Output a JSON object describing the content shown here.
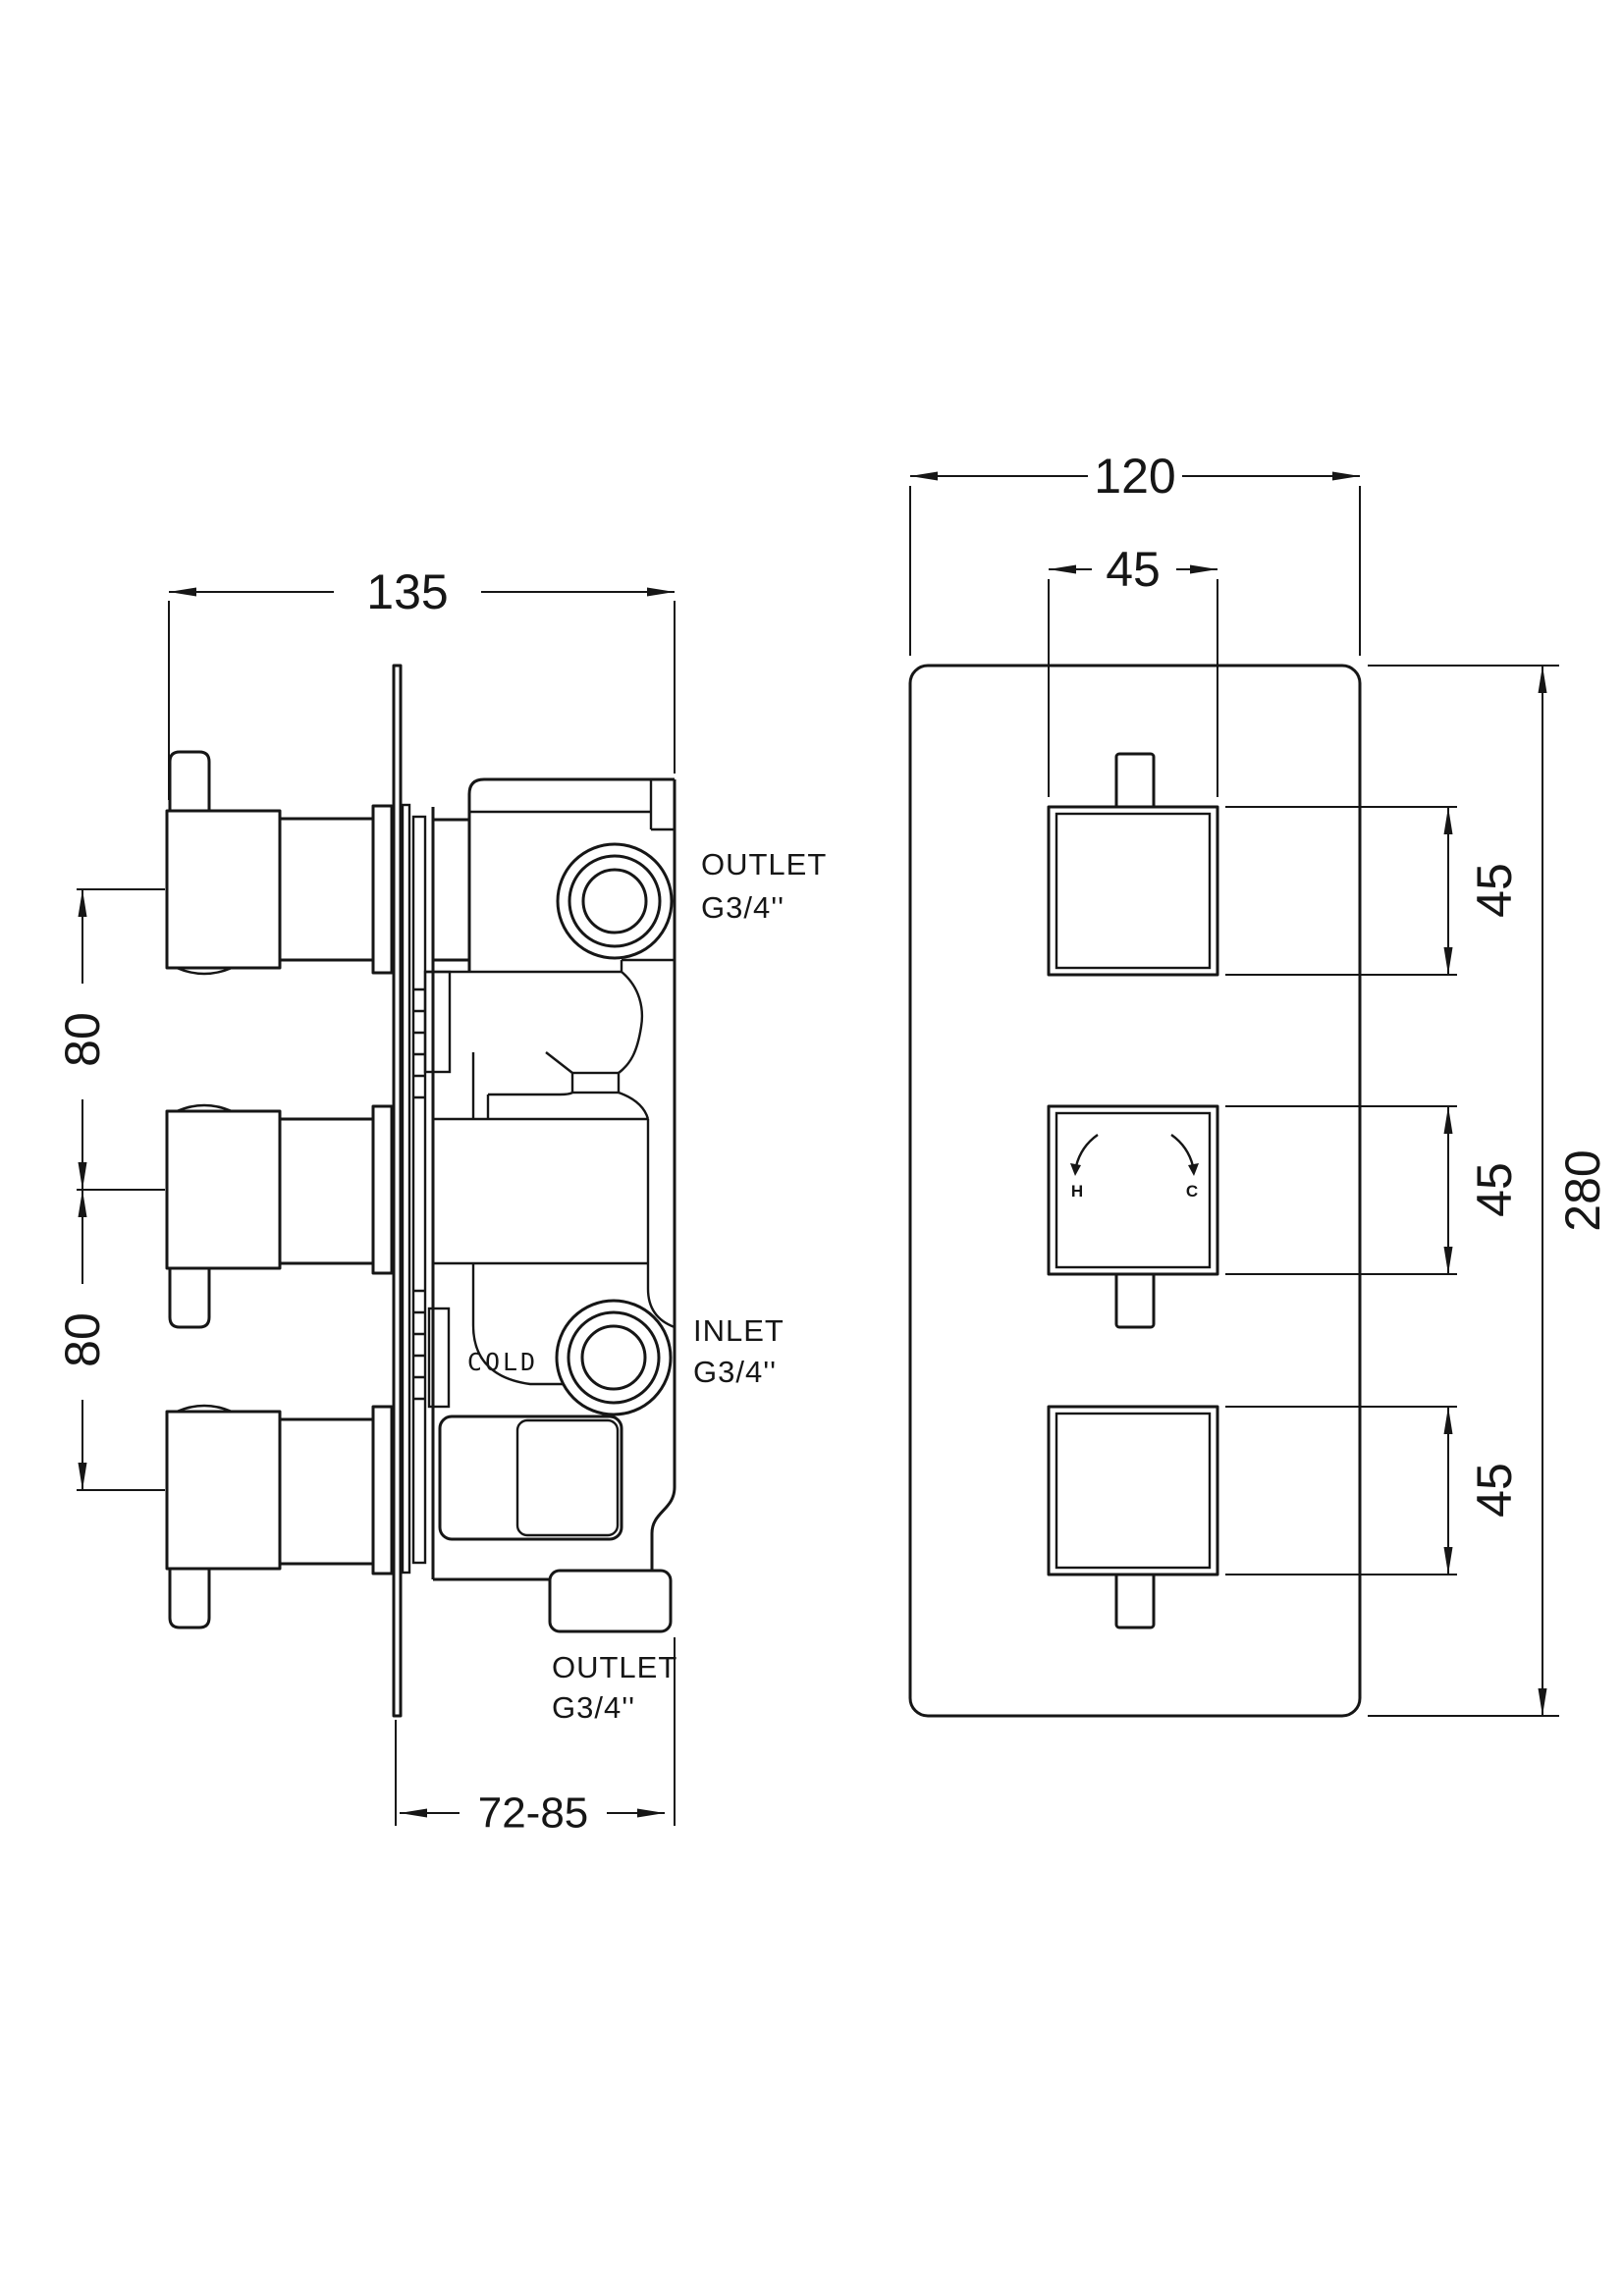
{
  "colors": {
    "line": "#161616",
    "background": "#ffffff"
  },
  "side_view": {
    "dim_width": "135",
    "dim_spacing_top": "80",
    "dim_spacing_bottom": "80",
    "dim_depth": "72-85",
    "outlet_top_label_line1": "OUTLET",
    "outlet_top_label_line2": "G3/4''",
    "inlet_label_line1": "INLET",
    "inlet_label_line2": "G3/4''",
    "outlet_bottom_label_line1": "OUTLET",
    "outlet_bottom_label_line2": "G3/4''",
    "cold_label": "COLD"
  },
  "front_view": {
    "dim_width": "120",
    "dim_handle_width": "45",
    "dim_handle_height_top": "45",
    "dim_handle_height_middle": "45",
    "dim_handle_height_bottom": "45",
    "dim_height": "280",
    "hot_label": "H",
    "cold_label": "C"
  }
}
